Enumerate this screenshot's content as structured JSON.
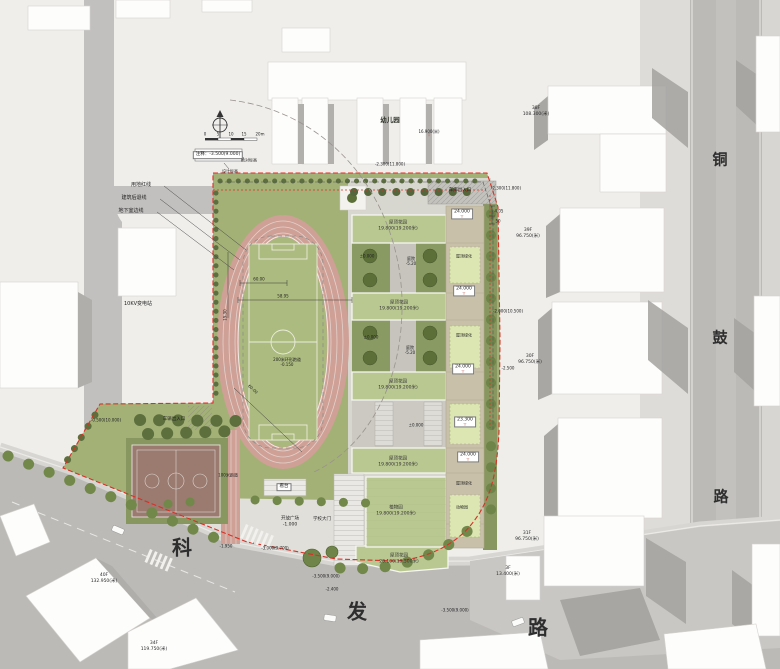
{
  "compass": {
    "ticks": [
      "0",
      "5",
      "10",
      "15",
      "20m"
    ]
  },
  "legend": {
    "note": "注释：-3.500(9.000)",
    "abs_label": "绝对标高",
    "design_label": "设计标高"
  },
  "lines": {
    "red_line": "用地红线",
    "setback_line": "建筑后退线",
    "basement_line": "地下室边线"
  },
  "streets": {
    "tonggu": [
      "铜",
      "鼓",
      "路"
    ],
    "kefa": [
      "科",
      "发",
      "路"
    ]
  },
  "context": {
    "kindergarten": "幼儿园",
    "kindergarten_height": "16.900(米)",
    "substation": "10KV变电站",
    "towers": [
      {
        "floors": "38F",
        "height": "108.300(米)"
      },
      {
        "floors": "39F",
        "height": "96.750(米)"
      },
      {
        "floors": "30F",
        "height": "96.750(米)"
      },
      {
        "floors": "31F",
        "height": "96.750(米)"
      },
      {
        "floors": "3F",
        "height": "13.400(米)"
      },
      {
        "floors": "40F",
        "height": "132.950(米)"
      },
      {
        "floors": "34F",
        "height": "119.750(米)"
      }
    ]
  },
  "site": {
    "entrances": {
      "garage": "车库出入口",
      "vehicle": "车辆出入口",
      "gate": "学校大门"
    },
    "sports": {
      "track": "200米环形跑道",
      "track_elev": "-0.150",
      "sprint": "100米跑道",
      "stand": "看台"
    },
    "plaza": {
      "name": "开放广场",
      "elev": "-1.000"
    },
    "courtyards": [
      {
        "name": "庭院",
        "elev": "-5.20"
      },
      {
        "name": "庭院",
        "elev": "-5.20"
      }
    ],
    "roofs": [
      {
        "name": "屋顶花园",
        "height": "19.800(19.200米)"
      },
      {
        "name": "屋顶花园",
        "height": "19.800(19.200米)"
      },
      {
        "name": "屋顶花园",
        "height": "19.800(19.200米)"
      },
      {
        "name": "屋顶花园",
        "height": "19.800(19.200米)"
      },
      {
        "name": "植物园",
        "height": "19.800(19.200米)"
      },
      {
        "name": "屋顶花园",
        "height": "20.100(19.500米)"
      }
    ],
    "green_roofs": [
      "屋顶绿化",
      "屋顶绿化",
      "屋顶绿化",
      "动物园"
    ],
    "lifts": [
      "24.000",
      "24.000",
      "24.000",
      "23.300",
      "24.000"
    ],
    "zeros": [
      "±0.000",
      "±0.000",
      "±0.000"
    ]
  },
  "elevations": {
    "top_a": "-2.300(11.800)",
    "top_b": "-2.300(11.800)",
    "west": "-0.500(10.000)",
    "road_a": "-1.950",
    "road_b": "-3.000(9.700)",
    "road_c": "-3.500(9.000)",
    "road_d": "-2.400",
    "road_e": "-3.500(9.000)",
    "east_a": "-2.000(10.500)",
    "east_b": "-2.500"
  },
  "dims": {
    "d1": "58.95",
    "d2": "60.00",
    "d3": "60.00",
    "d4": "15.30",
    "d5": "4.05",
    "d6": "50"
  },
  "glyphs": {
    "flag": "▽"
  },
  "colors": {
    "boundary_red": "#d93025",
    "site_green": "#a3b176",
    "track_pink": "#cfa096",
    "roof_green": "#b9c791"
  }
}
